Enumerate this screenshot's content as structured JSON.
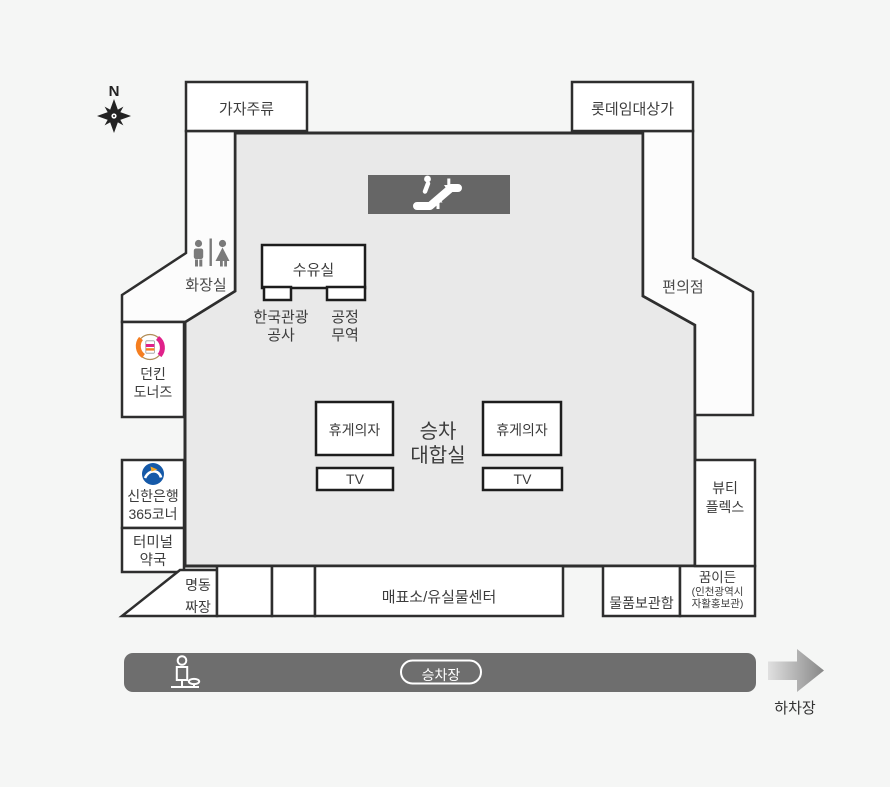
{
  "title": "터미널 승차장 층별 안내도",
  "compass": {
    "north": "N"
  },
  "rooms": {
    "gaja_liquor": "가자주류",
    "lotte_rental_mall": "롯데임대상가",
    "restroom": "화장실",
    "nursing_room": "수유실",
    "korea_tourism_org": [
      "한국관광",
      "공사"
    ],
    "fair_trade": [
      "공정",
      "무역"
    ],
    "convenience_store": "편의점",
    "rest_chairs_left": "휴게의자",
    "rest_chairs_right": "휴게의자",
    "boarding_hall": [
      "승차",
      "대합실"
    ],
    "tv_left": "TV",
    "tv_right": "TV",
    "dunkin": [
      "던킨",
      "도너즈"
    ],
    "shinhan": [
      "신한은행",
      "365코너"
    ],
    "pharmacy": [
      "터미널",
      "약국"
    ],
    "myeongdong_jjajang": [
      "명동",
      "짜장"
    ],
    "beauty_plex": [
      "뷰티",
      "플렉스"
    ],
    "ticket_lost_found": "매표소/유실물센터",
    "lockers": "물품보관함",
    "kkumideun": {
      "title": "꿈이든",
      "subtitle": [
        "(인천광역시",
        "자활홍보관)"
      ]
    }
  },
  "platform": {
    "boarding": "승차장",
    "alighting": "하차장"
  },
  "icons": {
    "compass": "compass-rose-icon",
    "escalator": "escalator-icon",
    "restroom": "restroom-icon",
    "dunkin_logo": "dunkin-donuts-logo",
    "shinhan_logo": "shinhan-bank-logo",
    "bus_stop": "bus-stop-icon",
    "arrow": "arrow-right-icon"
  },
  "colors": {
    "background": "#f5f6f5",
    "hall_fill": "#e9e9e9",
    "wall": "#2e2e2e",
    "room_fill": "#ffffff",
    "dark_box": "#666666",
    "platform_bar": "#6e6e6e",
    "dunkin_orange": "#f57e20",
    "dunkin_pink": "#e0218a",
    "shinhan_blue": "#1559a8"
  }
}
